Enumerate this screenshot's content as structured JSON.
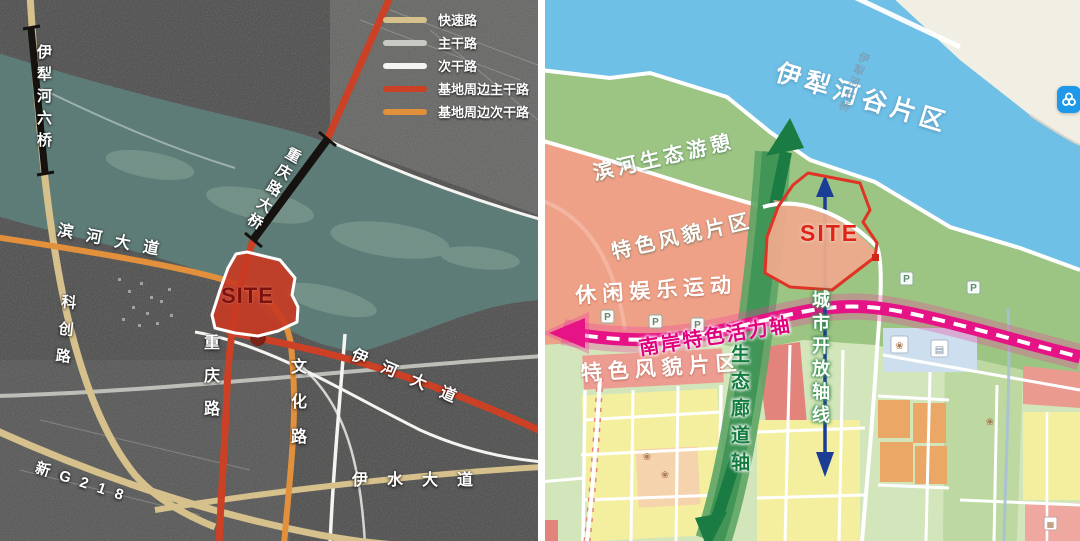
{
  "left_panel": {
    "type": "satellite-road-map",
    "legend": {
      "items": [
        {
          "label": "快速路",
          "color": "#d6c08b"
        },
        {
          "label": "主干路",
          "color": "#c9c9c3"
        },
        {
          "label": "次干路",
          "color": "#f4f4f0"
        },
        {
          "label": "基地周边主干路",
          "color": "#cc4125"
        },
        {
          "label": "基地周边次干路",
          "color": "#e2903c"
        }
      ]
    },
    "labels": {
      "bridge6": "伊犁河六桥",
      "binhe": "滨河大道",
      "kechuang": "科创路",
      "cq_bridge": "重庆路大桥",
      "chongqing": "重庆路",
      "wenhua": "文化路",
      "yihe": "伊河大道",
      "yishui": "伊水大道",
      "g218": "新G218",
      "site": "SITE"
    },
    "colors": {
      "site_fill": "#c93a22",
      "river_tint": "#5f837d",
      "bridge_mark": "#151210"
    }
  },
  "right_panel": {
    "type": "planning-structure-map",
    "labels": {
      "valley": "伊犁河谷片区",
      "bridge7": "伊犁河七桥",
      "riverfront_line1": "滨河生态游憩",
      "riverfront_line2": "特色风貌片区",
      "leisure_line1": "休闲娱乐运动",
      "leisure_line2": "特色风貌片区",
      "site": "SITE",
      "south_axis": "南岸特色活力轴",
      "eco_axis": "生态廊道轴",
      "open_axis": "城市开放轴线",
      "parking": "P"
    },
    "colors": {
      "water": "#6fc0e6",
      "green_base": "#9cc483",
      "salmon_zone": "#efa188",
      "corridor_green": "#3f9355",
      "axis_magenta": "#e51385",
      "open_axis_blue": "#1c3d96",
      "site_outline": "#e03325",
      "yellow_block": "#f3ef9e",
      "orange_block": "#eaa766",
      "pink_block": "#ec9c90"
    }
  }
}
